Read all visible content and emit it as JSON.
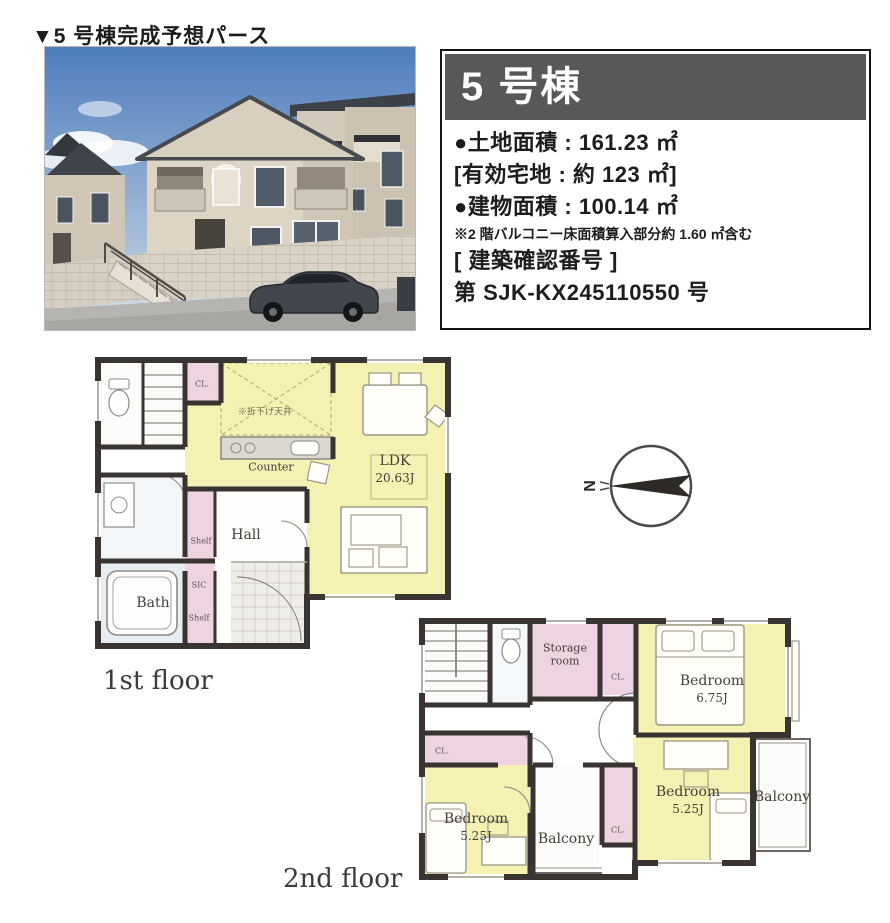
{
  "title": "▼5 号棟完成予想パース",
  "info_box": {
    "header": "5 号棟",
    "line_land": "●土地面積 : 161.23 ㎡",
    "line_effective": "[有効宅地 : 約 123 ㎡]",
    "line_building": "●建物面積 : 100.14 ㎡",
    "line_note": "※2 階バルコニー床面積算入部分約 1.60 ㎡含む",
    "line_confirm_label": "[ 建築確認番号 ]",
    "line_confirm_no": "第 SJK-KX245110550 号"
  },
  "compass": {
    "north": "N"
  },
  "floor1": {
    "caption": "1st floor",
    "labels": {
      "cl": "CL.",
      "ceiling_note": "※折下げ天井",
      "counter": "Counter",
      "ldk": "LDK",
      "ldk_size": "20.63J",
      "hall": "Hall",
      "shelf_upper": "Shelf",
      "bath": "Bath",
      "sic": "SIC",
      "shelf_lower": "Shelf"
    }
  },
  "floor2": {
    "caption": "2nd floor",
    "labels": {
      "storage": "Storage room",
      "cl_top": "CL.",
      "bedroom_main": "Bedroom",
      "bedroom_main_size": "6.75J",
      "cl_left": "CL.",
      "bedroom_left": "Bedroom",
      "bedroom_left_size": "5.25J",
      "balcony_center": "Balcony",
      "cl_mid": "CL.",
      "bedroom_right": "Bedroom",
      "bedroom_right_size": "5.25J",
      "balcony_right": "Balcony"
    }
  },
  "colors": {
    "room_yellow": "#f5f1b2",
    "closet_pink": "#eed3e1",
    "wall_dark": "#393431",
    "info_header_bg": "#595757",
    "sky_blue": "#4e7dbd"
  }
}
